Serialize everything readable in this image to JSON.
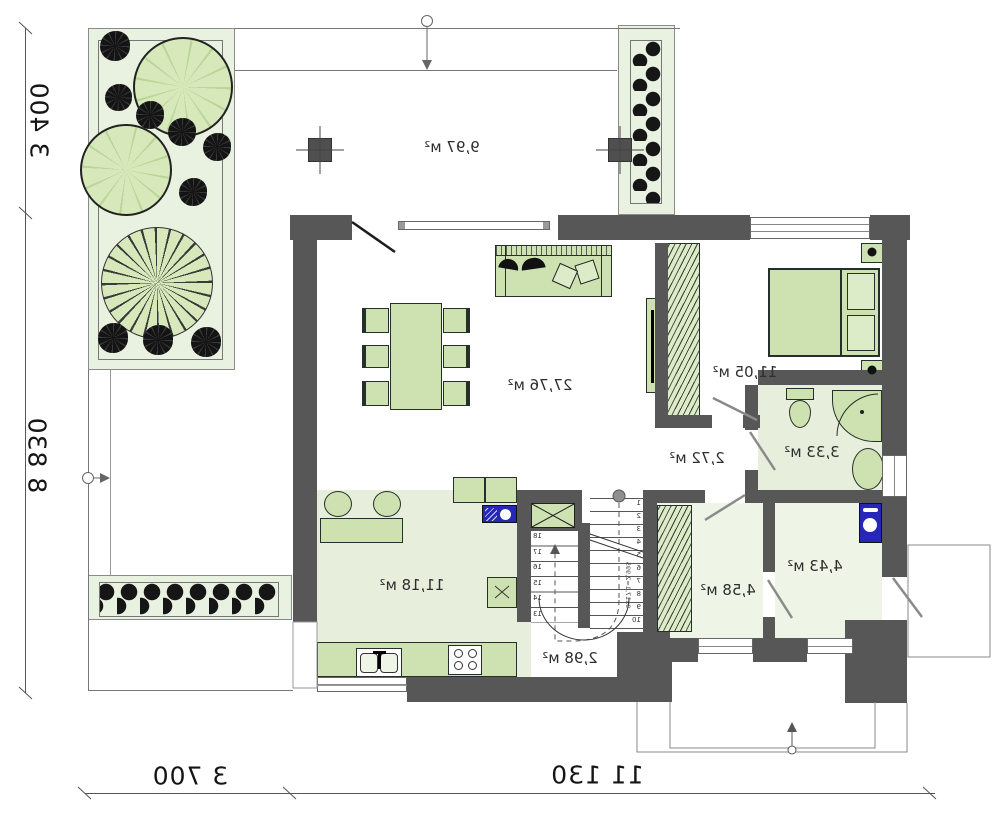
{
  "plan_title": "ground-floor-plan-mirrored",
  "rooms": {
    "terrace": "9,97 м²",
    "living": "27,76 м²",
    "bedroom": "11,05 м²",
    "bathroom": "3,33 м²",
    "hall": "2,72 м²",
    "kitchen": "11,18 м²",
    "stairs": "2,98 м²",
    "closet": "4,58 м²",
    "entry": "4,43 м²"
  },
  "dimensions": {
    "side_upper": "3 400",
    "side_lower": "8 830",
    "bottom_small": "3 700",
    "bottom_large": "11 130"
  },
  "stairs": {
    "note": "9x17,1=2,995",
    "left_steps": [
      "18",
      "17",
      "16",
      "15",
      "14",
      "13"
    ],
    "right_steps": [
      "1",
      "2",
      "3",
      "4",
      "5",
      "6",
      "7",
      "8",
      "9",
      "10"
    ]
  },
  "colors": {
    "wall": "#575757",
    "floor_green": "#e7efdc",
    "floor_light": "#eef4e6",
    "furniture_green": "#cde2b0",
    "tree_green": "#d7e8bb",
    "garden_bg": "#e9f1e1",
    "appliance_blue": "#2626b8",
    "plant_dark": "#161616",
    "line_dark": "#333333"
  }
}
